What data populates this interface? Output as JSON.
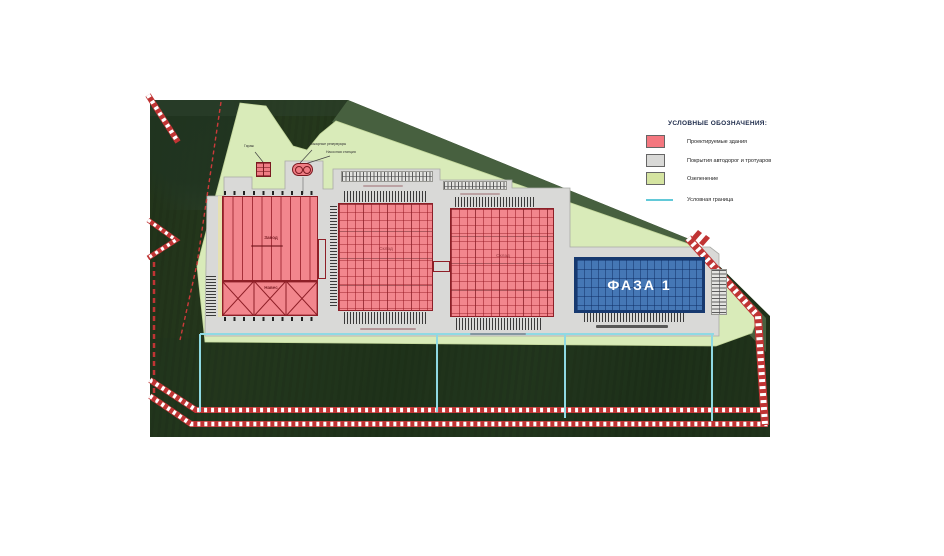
{
  "legend": {
    "title": "УСЛОВНЫЕ ОБОЗНАЧЕНИЯ:",
    "items": [
      {
        "label": "Проектируемые здания",
        "swatch": "#f4777f"
      },
      {
        "label": "Покрытия автодорог и тротуаров",
        "swatch": "#d9d9d7"
      },
      {
        "label": "Озеленение",
        "swatch": "#d5e4a1"
      },
      {
        "label": "Условная граница",
        "swatch": "#62c9d8"
      }
    ]
  },
  "plan": {
    "phase1_label": "ФАЗА 1",
    "building1": {
      "label": "Завод",
      "canopy_label": "Навес"
    },
    "warehouse2_label": "Склад",
    "warehouse3_label": "Склад",
    "garage_label": "Гараж",
    "fire_tanks_label": "Пожарные резервуары",
    "pump_station_label": "Насосная станция"
  },
  "colors": {
    "building_red": "#f4777f",
    "pavement_gray": "#d9d9d7",
    "greenery": "#d5e4a1",
    "boundary_cyan": "#62c9d8",
    "phase_blue": "#4577b5",
    "road_mark_red": "#c03434"
  }
}
